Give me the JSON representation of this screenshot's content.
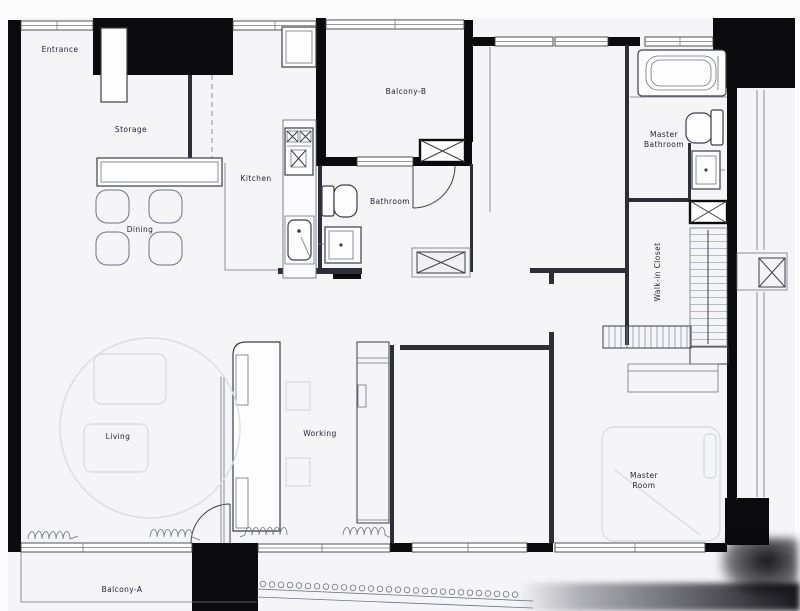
{
  "colors": {
    "canvas": "#fcfcfd",
    "paper": "#f5f5f8",
    "wall": "#0b0b0e",
    "wall_inner": "#2e2e38",
    "line_dark": "#3c3c48",
    "line_mid": "#707482",
    "line_faint": "#d9dce6",
    "label": "#1f1f33"
  },
  "rooms": {
    "entrance": {
      "label": "Entrance"
    },
    "storage": {
      "label": "Storage"
    },
    "kitchen": {
      "label": "Kitchen"
    },
    "dining": {
      "label": "Dining"
    },
    "balcony_b": {
      "label": "Balcony-B"
    },
    "bathroom": {
      "label": "Bathroom"
    },
    "master_bathroom": {
      "label": "Master Bathroom"
    },
    "walk_in_closet": {
      "label": "Walk-in Closet"
    },
    "living": {
      "label": "Living"
    },
    "working": {
      "label": "Working"
    },
    "master_room": {
      "label": "Master Room"
    },
    "balcony_a": {
      "label": "Balcony-A"
    }
  },
  "balcony_a_railing": {
    "posts": 29
  }
}
